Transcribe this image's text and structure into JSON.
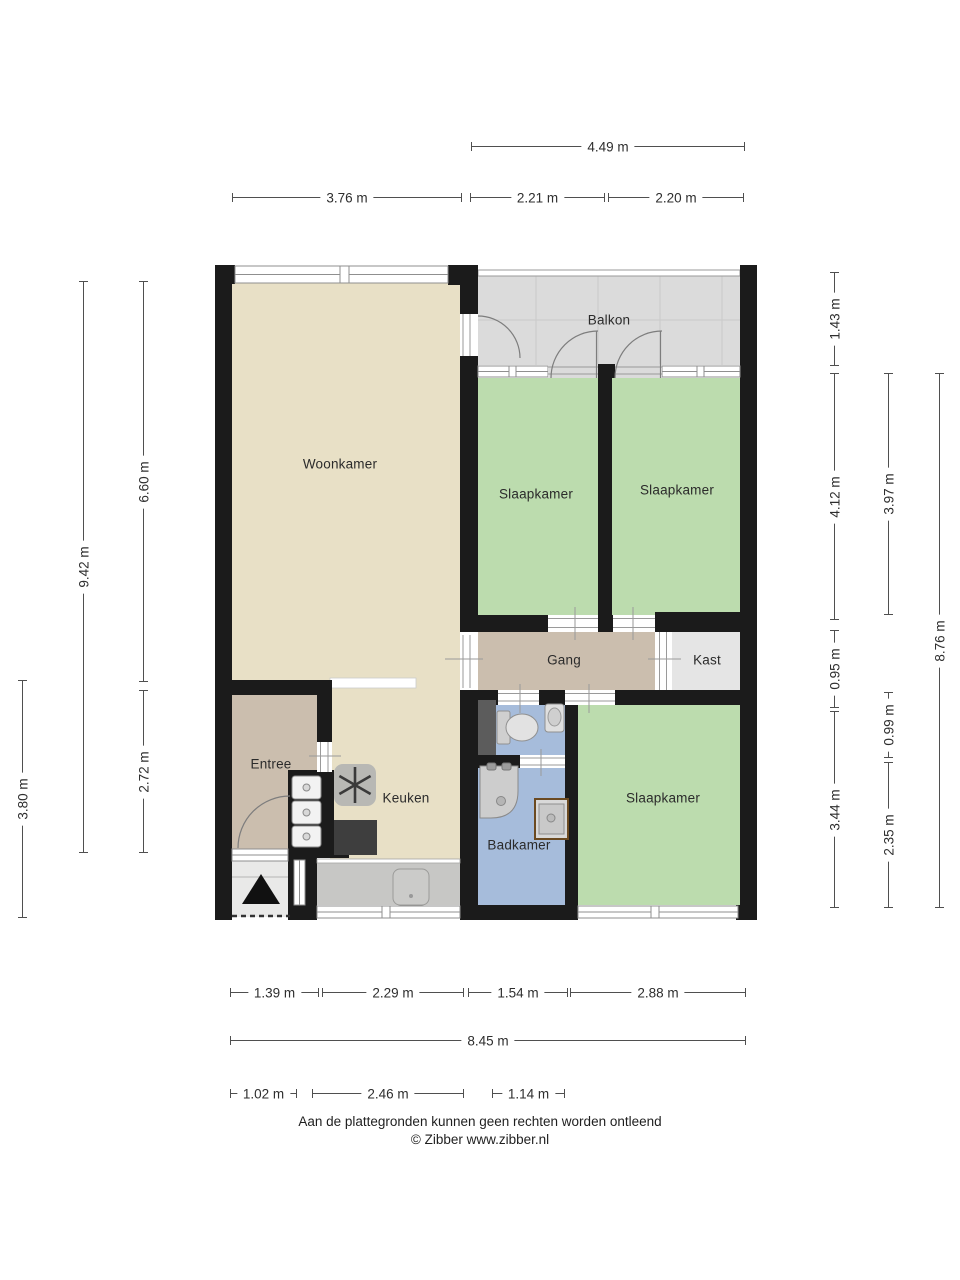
{
  "rooms": {
    "woonkamer": "Woonkamer",
    "slaapkamer_1": "Slaapkamer",
    "slaapkamer_2": "Slaapkamer",
    "slaapkamer_3": "Slaapkamer",
    "balkon": "Balkon",
    "gang": "Gang",
    "kast": "Kast",
    "entree": "Entree",
    "keuken": "Keuken",
    "badkamer": "Badkamer"
  },
  "dims": {
    "top_total": "4.49 m",
    "top_1": "3.76 m",
    "top_2": "2.21 m",
    "top_3": "2.20 m",
    "right_1": "1.43 m",
    "right_2": "4.12 m",
    "right_3": "0.95 m",
    "right_4": "3.44 m",
    "right_5": "3.97 m",
    "right_6": "0.99 m",
    "right_7": "2.35 m",
    "right_8": "8.76 m",
    "left_1": "9.42 m",
    "left_2": "6.60 m",
    "left_3": "2.72 m",
    "left_4": "3.80 m",
    "bottom_1": "1.39 m",
    "bottom_2": "2.29 m",
    "bottom_3": "1.54 m",
    "bottom_4": "2.88 m",
    "bottom_total": "8.45 m",
    "bottom_5": "1.02 m",
    "bottom_6": "2.46 m",
    "bottom_7": "1.14 m"
  },
  "footer": {
    "disclaimer": "Aan de plattegronden kunnen geen rechten worden ontleend",
    "copyright": "© Zibber www.zibber.nl"
  },
  "colors": {
    "wall": "#1b1b1b",
    "floor_living": "#e8e0c6",
    "floor_hall": "#cbbeae",
    "floor_bedroom": "#bcdcae",
    "floor_bath": "#a6bcdb",
    "floor_balcony": "#dbdbdb",
    "floor_closet": "#e5e5e5",
    "floor_porch": "#e9e9e8",
    "floor_strip": "#c7c7c5",
    "shaft": "#5c5c5c"
  }
}
